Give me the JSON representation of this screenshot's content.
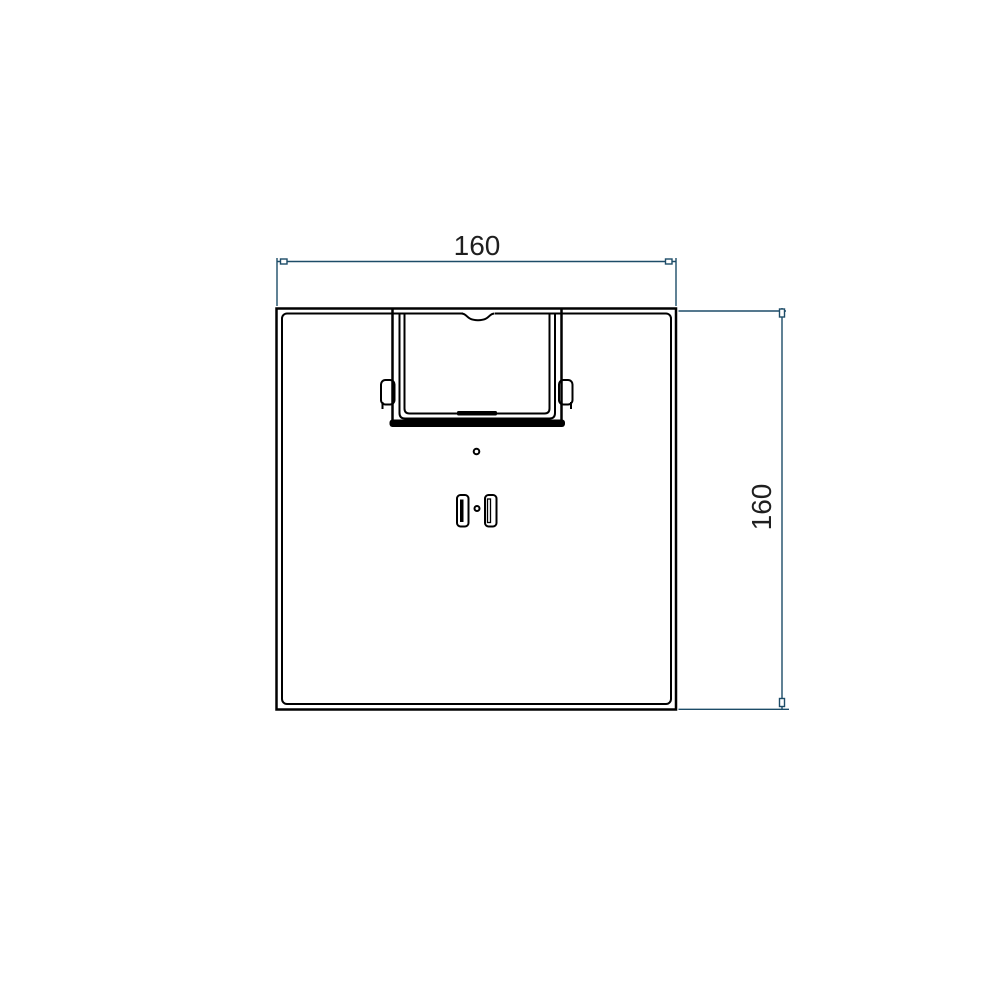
{
  "drawing": {
    "colors": {
      "background": "#ffffff",
      "line_color": "#000000",
      "dim_color": "#1d4c68",
      "text_color": "#1f1f1f"
    },
    "dimensions": {
      "horizontal": {
        "label": "160"
      },
      "vertical": {
        "label": "160"
      }
    }
  }
}
